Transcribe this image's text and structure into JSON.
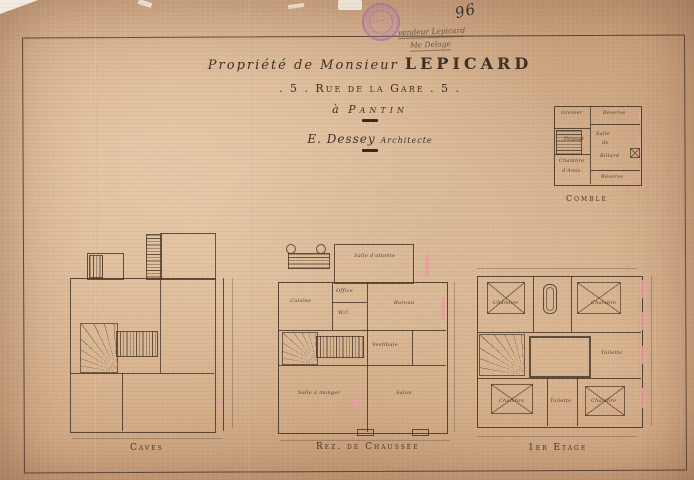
{
  "document": {
    "title_script": "Propriété de Monsieur",
    "title_name": "LEPICARD",
    "address": ". 5 . Rue de la Gare . 5 .",
    "city_prefix": "à",
    "city": "Pantin",
    "architect_name": "E. Dessey",
    "architect_role": "Architecte",
    "page_number": "96",
    "handwritten_note_line1": "vendeur Lepicard",
    "handwritten_note_line2": "Me Delage"
  },
  "plans": [
    {
      "id": "comble",
      "caption": "Comble",
      "rooms": [
        {
          "label": "Grenier",
          "x": 15,
          "y": 12
        },
        {
          "label": "Réserve",
          "x": 57,
          "y": 12
        },
        {
          "label": "Dégagt",
          "x": 18,
          "y": 38
        },
        {
          "label": "Salle",
          "x": 50,
          "y": 33
        },
        {
          "label": "de",
          "x": 56,
          "y": 42
        },
        {
          "label": "Billard",
          "x": 54,
          "y": 55
        },
        {
          "label": "Chambre",
          "x": 13,
          "y": 60
        },
        {
          "label": "d'Amis",
          "x": 16,
          "y": 70
        },
        {
          "label": "Réserve",
          "x": 55,
          "y": 76
        }
      ]
    },
    {
      "id": "caves",
      "caption": "Caves",
      "rooms": []
    },
    {
      "id": "rez",
      "caption": "Rez. de Chaussée",
      "rooms": [
        {
          "label": "Salle d'attente",
          "x": 82,
          "y": 13
        },
        {
          "label": "Cuisine",
          "x": 18,
          "y": 58
        },
        {
          "label": "Office",
          "x": 64,
          "y": 48
        },
        {
          "label": "W.C.",
          "x": 66,
          "y": 70
        },
        {
          "label": "Bureau",
          "x": 122,
          "y": 60
        },
        {
          "label": "Vestibule",
          "x": 100,
          "y": 102
        },
        {
          "label": "Salle à manger",
          "x": 26,
          "y": 150
        },
        {
          "label": "Salon",
          "x": 124,
          "y": 150
        }
      ]
    },
    {
      "id": "etage",
      "caption": "1er Etage",
      "rooms": [
        {
          "label": "Chambre",
          "x": 28,
          "y": 60
        },
        {
          "label": "Chambre",
          "x": 126,
          "y": 60
        },
        {
          "label": "Toilette",
          "x": 136,
          "y": 110
        },
        {
          "label": "Chambre",
          "x": 34,
          "y": 158
        },
        {
          "label": "Toilette",
          "x": 85,
          "y": 158
        },
        {
          "label": "Chambre",
          "x": 126,
          "y": 158
        }
      ]
    }
  ],
  "colors": {
    "paper": "#d8b491",
    "ink": "#483626",
    "flue_pink": "#e79da6",
    "stamp_purple": "#a55faf"
  }
}
